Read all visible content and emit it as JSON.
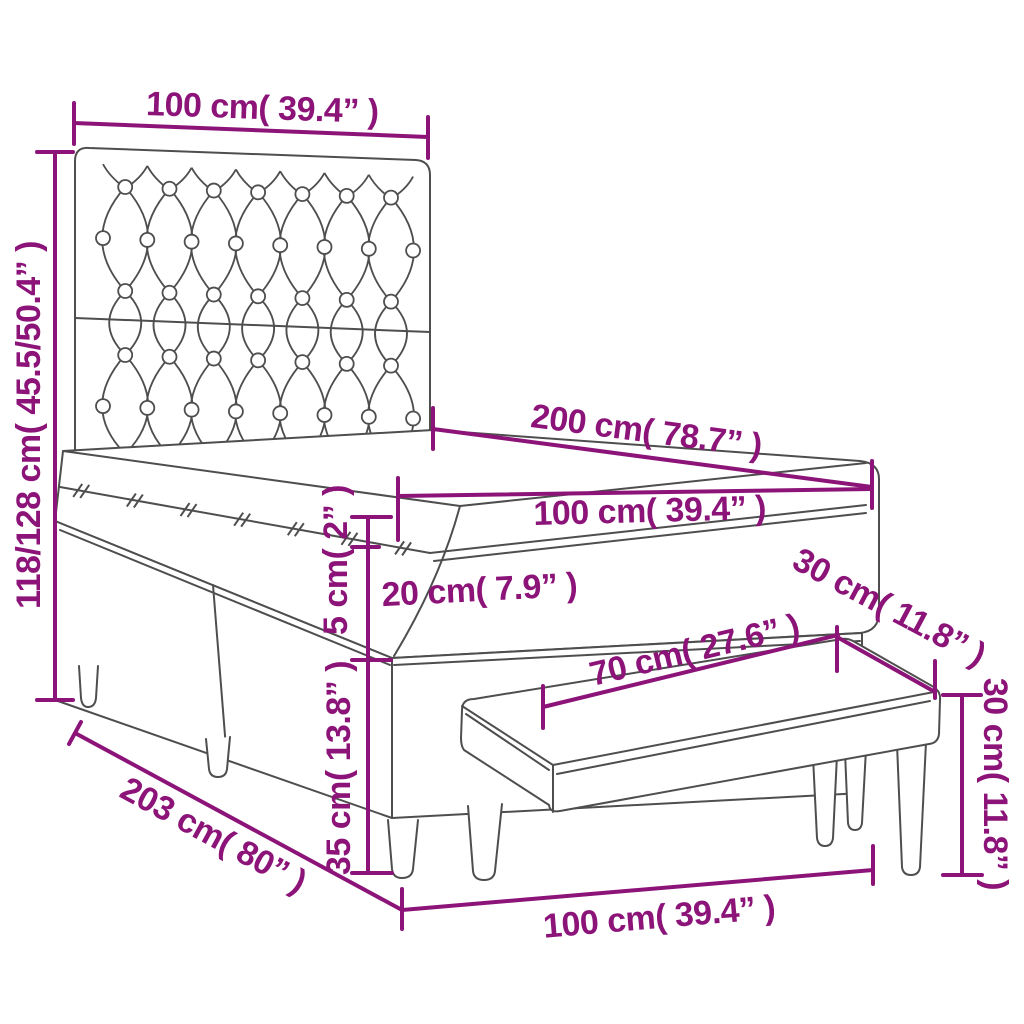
{
  "diagram": {
    "subject": "box spring bed with tufted headboard, mattress topper and bench - dimension drawing",
    "accent_color": "#8C1479",
    "outline_color": "#4E4E4E",
    "background_color": "#FFFFFF",
    "dimensions": {
      "headboard_width": "100 cm( 39.4” )",
      "overall_height": "118/128 cm( 45.5/50.4” )",
      "bed_length": "200 cm( 78.7” )",
      "mattress_width": "100 cm( 39.4” )",
      "topper_thickness": "5 cm( 2” )",
      "mattress_thickness": "20 cm( 7.9” )",
      "base_height": "35 cm( 13.8” )",
      "bed_overall_length": "203 cm( 80” )",
      "bench_seat_length": "70 cm( 27.6” )",
      "bench_depth": "30 cm( 11.8” )",
      "bench_height": "30 cm( 11.8” )",
      "bench_overall_length": "100 cm( 39.4” )"
    }
  }
}
